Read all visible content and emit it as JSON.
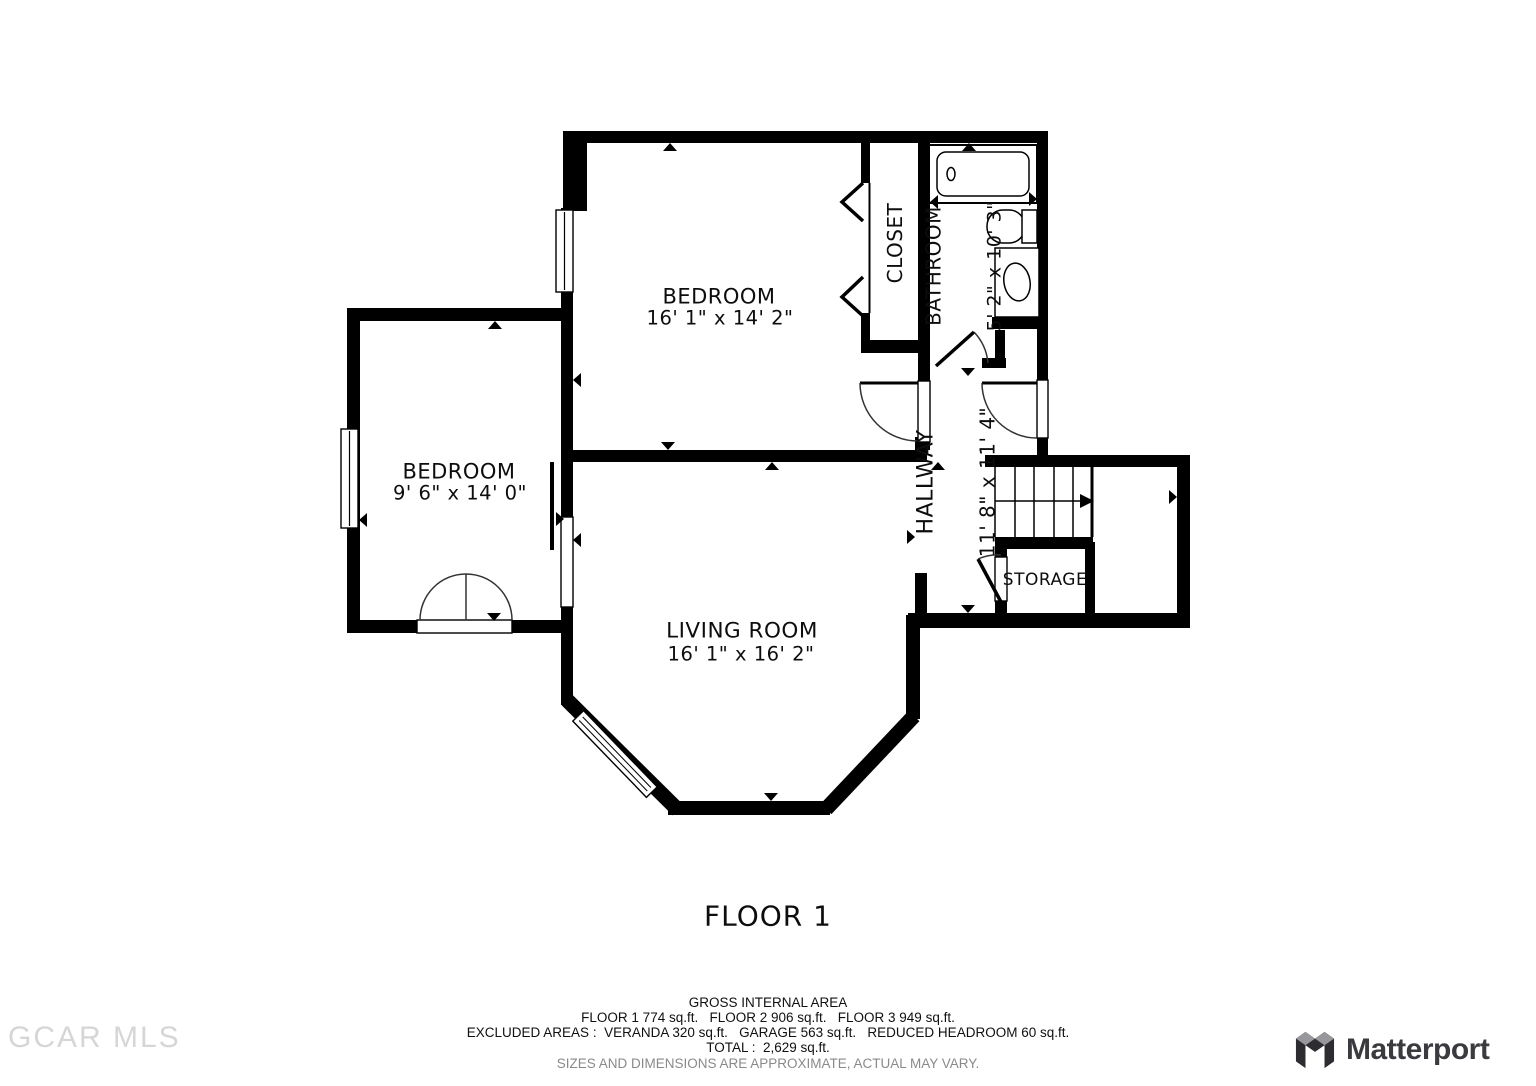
{
  "floor_plan": {
    "floor_label": "FLOOR 1",
    "rooms": {
      "bedroom_top": {
        "name": "BEDROOM",
        "dims": "16' 1\" x 14' 2\""
      },
      "bedroom_left": {
        "name": "BEDROOM",
        "dims": "9' 6\" x 14' 0\""
      },
      "living_room": {
        "name": "LIVING ROOM",
        "dims": "16' 1\" x 16' 2\""
      },
      "bathroom": {
        "name": "BATHROOM",
        "dims": "5' 2\" x 10' 3\""
      },
      "hallway": {
        "name": "HALLWAY",
        "dims": "11' 8\" x 11' 4\""
      },
      "closet": {
        "name": "CLOSET"
      },
      "storage": {
        "name": "STORAGE"
      }
    }
  },
  "area_summary": {
    "heading": "GROSS INTERNAL AREA",
    "floors_line": "FLOOR 1 774 sq.ft.   FLOOR 2 906 sq.ft.   FLOOR 3 949 sq.ft.",
    "excluded_line": "EXCLUDED AREAS :  VERANDA 320 sq.ft.   GARAGE 563 sq.ft.   REDUCED HEADROOM 60 sq.ft.",
    "total_line": "TOTAL :  2,629 sq.ft.",
    "disclaimer": "SIZES AND DIMENSIONS ARE APPROXIMATE, ACTUAL MAY VARY."
  },
  "watermark": {
    "text": "GCAR MLS"
  },
  "branding": {
    "logo_text": "Matterport"
  },
  "colors": {
    "wall": "#000000",
    "background": "#ffffff",
    "disclaimer_text": "#8a8a8a",
    "watermark_text": "#d6d6d6",
    "logo_text_color": "#3a3a3f",
    "logo_gray": "#97979c",
    "logo_dark": "#2c2c31"
  }
}
